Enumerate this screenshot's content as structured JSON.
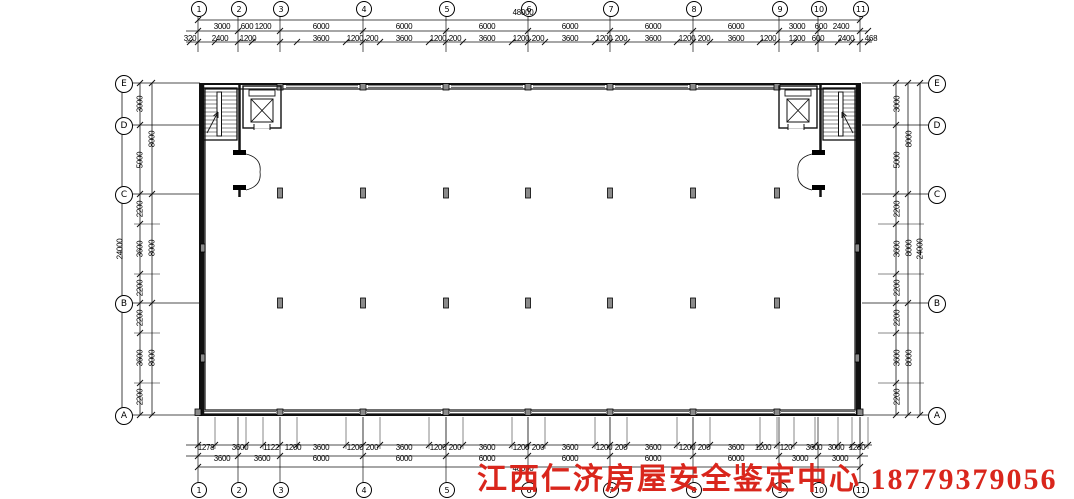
{
  "watermark": {
    "text": "江西仁济房屋安全鉴定中心 18779379056",
    "color": "#d9261c"
  },
  "axes": {
    "top": {
      "labels": [
        "1",
        "2",
        "3",
        "4",
        "5",
        "6",
        "7",
        "8",
        "9",
        "10",
        "11"
      ],
      "x": [
        198,
        238,
        280,
        363,
        446,
        528,
        610,
        693,
        779,
        818,
        860
      ],
      "y": 8
    },
    "bottom": {
      "labels": [
        "1",
        "2",
        "3",
        "4",
        "5",
        "6",
        "7",
        "8",
        "9",
        "10",
        "11"
      ],
      "x": [
        198,
        238,
        280,
        363,
        446,
        528,
        610,
        693,
        779,
        818,
        860
      ],
      "y": 489
    },
    "left": {
      "labels": [
        "E",
        "D",
        "C",
        "B",
        "A"
      ],
      "y": [
        83,
        125,
        194,
        303,
        415
      ],
      "x": 123
    },
    "right": {
      "labels": [
        "E",
        "D",
        "C",
        "B",
        "A"
      ],
      "y": [
        83,
        125,
        194,
        303,
        415
      ],
      "x": 936
    }
  },
  "dims": {
    "top_total": {
      "text": "48000",
      "x": 523,
      "y": 13
    },
    "top_bays": {
      "y": 27,
      "items": [
        [
          "3000",
          222
        ],
        [
          "600",
          247
        ],
        [
          "1200",
          263
        ],
        [
          "6000",
          321
        ],
        [
          "6000",
          404
        ],
        [
          "6000",
          487
        ],
        [
          "6000",
          570
        ],
        [
          "6000",
          653
        ],
        [
          "6000",
          736
        ],
        [
          "3000",
          797
        ],
        [
          "600",
          821
        ],
        [
          "2400",
          841
        ]
      ]
    },
    "top_detail": {
      "y": 39,
      "items": [
        [
          "320",
          190
        ],
        [
          "2400",
          220
        ],
        [
          "1200",
          248
        ],
        [
          "3600",
          321
        ],
        [
          "1200",
          355
        ],
        [
          "200",
          372
        ],
        [
          "3600",
          404
        ],
        [
          "1200",
          438
        ],
        [
          "200",
          455
        ],
        [
          "3600",
          487
        ],
        [
          "1200",
          521
        ],
        [
          "200",
          538
        ],
        [
          "3600",
          570
        ],
        [
          "1200",
          604
        ],
        [
          "200",
          621
        ],
        [
          "3600",
          653
        ],
        [
          "1200",
          687
        ],
        [
          "200",
          704
        ],
        [
          "3600",
          736
        ],
        [
          "1200",
          768
        ],
        [
          "1200",
          797
        ],
        [
          "600",
          818
        ],
        [
          "2400",
          846
        ],
        [
          "468",
          871
        ]
      ]
    },
    "bottom_detail": {
      "y": 448,
      "items": [
        [
          "1278",
          206
        ],
        [
          "3600",
          240
        ],
        [
          "1122",
          271
        ],
        [
          "1200",
          293
        ],
        [
          "3600",
          321
        ],
        [
          "1200",
          355
        ],
        [
          "200",
          372
        ],
        [
          "3600",
          404
        ],
        [
          "1200",
          438
        ],
        [
          "200",
          455
        ],
        [
          "3600",
          487
        ],
        [
          "1200",
          521
        ],
        [
          "200",
          538
        ],
        [
          "3600",
          570
        ],
        [
          "1200",
          604
        ],
        [
          "200",
          621
        ],
        [
          "3600",
          653
        ],
        [
          "1200",
          687
        ],
        [
          "200",
          704
        ],
        [
          "3600",
          736
        ],
        [
          "1200",
          763
        ],
        [
          "120",
          786
        ],
        [
          "3600",
          814
        ],
        [
          "3000",
          836
        ],
        [
          "1280",
          857
        ]
      ]
    },
    "bottom_bays": {
      "y": 459,
      "items": [
        [
          "3600",
          222
        ],
        [
          "3600",
          262
        ],
        [
          "6000",
          321
        ],
        [
          "6000",
          404
        ],
        [
          "6000",
          487
        ],
        [
          "6000",
          570
        ],
        [
          "6000",
          653
        ],
        [
          "6000",
          736
        ],
        [
          "3000",
          800
        ],
        [
          "3000",
          840
        ]
      ]
    },
    "bottom_total": {
      "text": "48000",
      "x": 523,
      "y": 469
    },
    "left_detail": {
      "x": 140,
      "items": [
        [
          "3000",
          104
        ],
        [
          "5000",
          160
        ],
        [
          "2200",
          209
        ],
        [
          "3600",
          249
        ],
        [
          "2200",
          288
        ],
        [
          "2200",
          318
        ],
        [
          "3600",
          358
        ],
        [
          "2200",
          397
        ]
      ]
    },
    "left_mid": {
      "x": 152,
      "items": [
        [
          "8000",
          139
        ],
        [
          "8000",
          248
        ],
        [
          "8000",
          358
        ]
      ]
    },
    "left_total": {
      "text": "24000",
      "x": 120,
      "y": 249
    },
    "right_detail": {
      "x": 897,
      "items": [
        [
          "3000",
          104
        ],
        [
          "5000",
          160
        ],
        [
          "2200",
          209
        ],
        [
          "3600",
          249
        ],
        [
          "2200",
          288
        ],
        [
          "2200",
          318
        ],
        [
          "3600",
          358
        ],
        [
          "2200",
          397
        ]
      ]
    },
    "right_mid": {
      "x": 909,
      "items": [
        [
          "8000",
          139
        ],
        [
          "8000",
          248
        ],
        [
          "8000",
          358
        ]
      ]
    },
    "right_total": {
      "text": "24000",
      "x": 920,
      "y": 249
    }
  }
}
